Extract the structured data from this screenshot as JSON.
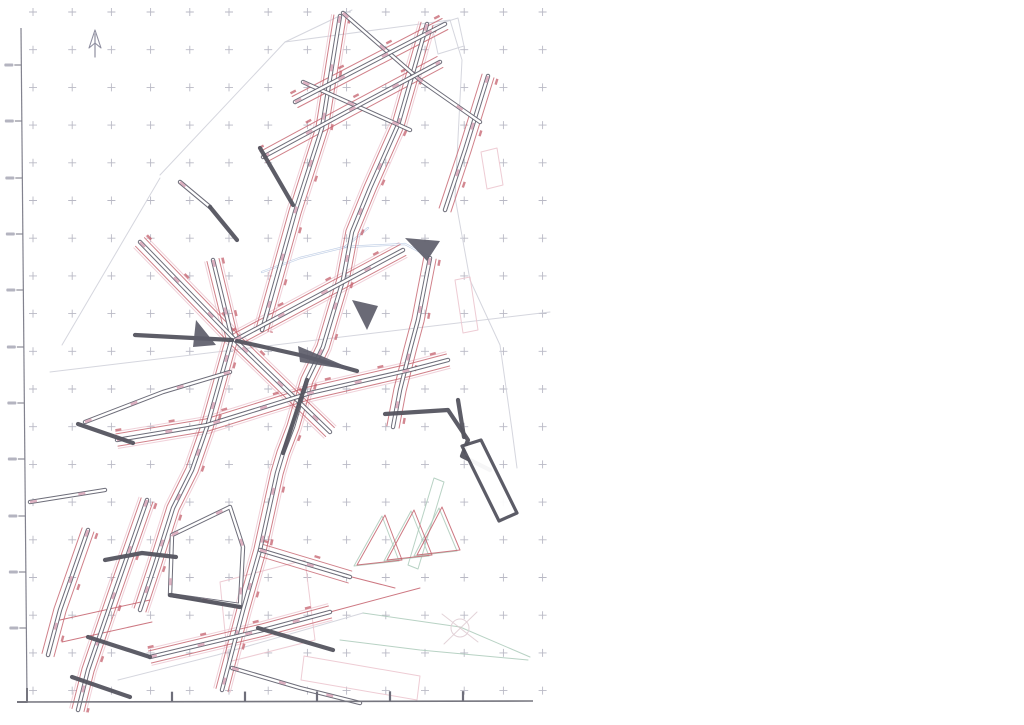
{
  "map": {
    "width": 1024,
    "height": 725,
    "colors": {
      "paper": "#ffffff",
      "cross": "#a8a8b6",
      "street_dark": "#61616e",
      "street_core": "#ffffff",
      "street_bold": "#54545f",
      "pink_blob": "#d9a9ba",
      "pink_line": "#ecc6cf",
      "red_line": "#c4606c",
      "green_line": "#abcaba",
      "blue_line": "#8aa6cf",
      "faint_gray": "#d0d2da",
      "ruler": "#82828e",
      "stub": "#b4b4c0",
      "wedge": "#5d5d6a"
    },
    "grid": {
      "x0": 33,
      "dx": 39.2,
      "cols": 14,
      "y0": 12,
      "dy": 37.7,
      "rows": 19,
      "arm": 4
    },
    "ruler": {
      "top": [
        21,
        28
      ],
      "bottom": [
        27,
        700
      ],
      "tick_ys": [
        65,
        121,
        178,
        234,
        290,
        347,
        403,
        459,
        516,
        572,
        628
      ],
      "tick_len": 7,
      "stub_w": 9,
      "stub_h": 3
    },
    "bottom_border": {
      "from": [
        17,
        702
      ],
      "to": [
        533,
        701
      ],
      "tick_xs": [
        172,
        245,
        317,
        390,
        463
      ],
      "tick_len": 10
    },
    "corner_mark": [
      [
        27,
        688
      ],
      [
        27,
        702
      ],
      [
        17,
        702
      ]
    ],
    "north_arrow": {
      "tail": [
        [
          95,
          57
        ],
        [
          95,
          34
        ]
      ],
      "head": [
        [
          89,
          48
        ],
        [
          95,
          30
        ],
        [
          101,
          48
        ],
        [
          95,
          43
        ]
      ]
    },
    "compass_star": {
      "cx": 460,
      "cy": 628,
      "r": 9,
      "lines": [
        [
          [
            442,
            614
          ],
          [
            478,
            642
          ]
        ],
        [
          [
            444,
            644
          ],
          [
            477,
            612
          ]
        ]
      ]
    },
    "layers": {
      "faint": [
        [
          [
            160,
            175
          ],
          [
            285,
            42
          ],
          [
            352,
            10
          ]
        ],
        [
          [
            285,
            42
          ],
          [
            450,
            20
          ],
          [
            462,
            60
          ],
          [
            455,
            197
          ]
        ],
        [
          [
            50,
            372
          ],
          [
            550,
            312
          ]
        ],
        [
          [
            118,
            680
          ],
          [
            217,
            655
          ],
          [
            363,
            613
          ]
        ],
        [
          [
            62,
            345
          ],
          [
            160,
            178
          ]
        ],
        [
          [
            432,
            26
          ],
          [
            458,
            18
          ],
          [
            464,
            46
          ],
          [
            438,
            54
          ],
          [
            432,
            26
          ]
        ],
        [
          [
            455,
            197
          ],
          [
            470,
            280
          ],
          [
            500,
            345
          ],
          [
            512,
            430
          ],
          [
            517,
            468
          ]
        ]
      ],
      "green": [
        [
          [
            363,
            613
          ],
          [
            460,
            627
          ],
          [
            530,
            657
          ]
        ],
        [
          [
            340,
            640
          ],
          [
            420,
            650
          ],
          [
            528,
            660
          ]
        ],
        [
          [
            408,
            565
          ],
          [
            434,
            478
          ],
          [
            444,
            482
          ],
          [
            418,
            569
          ],
          [
            408,
            565
          ]
        ],
        [
          [
            354,
            566
          ],
          [
            382,
            516
          ],
          [
            399,
            561
          ],
          [
            354,
            566
          ]
        ],
        [
          [
            384,
            561
          ],
          [
            411,
            511
          ],
          [
            429,
            556
          ],
          [
            384,
            561
          ]
        ],
        [
          [
            414,
            556
          ],
          [
            439,
            508
          ],
          [
            457,
            551
          ],
          [
            414,
            556
          ]
        ]
      ],
      "pink": [
        [
          [
            220,
            582
          ],
          [
            305,
            560
          ],
          [
            315,
            640
          ],
          [
            228,
            662
          ],
          [
            220,
            582
          ]
        ],
        [
          [
            304,
            656
          ],
          [
            420,
            676
          ],
          [
            417,
            700
          ],
          [
            301,
            680
          ],
          [
            304,
            656
          ]
        ],
        [
          [
            455,
            280
          ],
          [
            470,
            277
          ],
          [
            478,
            330
          ],
          [
            463,
            333
          ],
          [
            455,
            280
          ]
        ],
        [
          [
            481,
            152
          ],
          [
            497,
            148
          ],
          [
            503,
            185
          ],
          [
            487,
            189
          ],
          [
            481,
            152
          ]
        ]
      ],
      "blue": [
        [
          [
            262,
            272
          ],
          [
            300,
            258
          ],
          [
            345,
            247
          ],
          [
            405,
            244
          ],
          [
            428,
            256
          ]
        ],
        [
          [
            345,
            247
          ],
          [
            368,
            228
          ]
        ]
      ],
      "red": [
        [
          [
            330,
            612
          ],
          [
            420,
            588
          ]
        ],
        [
          [
            60,
            620
          ],
          [
            150,
            600
          ]
        ],
        [
          [
            62,
            642
          ],
          [
            152,
            622
          ]
        ],
        [
          [
            352,
            577
          ],
          [
            395,
            588
          ]
        ],
        [
          [
            357,
            565
          ],
          [
            385,
            515
          ],
          [
            402,
            560
          ],
          [
            357,
            565
          ]
        ],
        [
          [
            387,
            560
          ],
          [
            414,
            510
          ],
          [
            432,
            555
          ],
          [
            387,
            560
          ]
        ],
        [
          [
            417,
            555
          ],
          [
            442,
            507
          ],
          [
            460,
            550
          ],
          [
            417,
            555
          ]
        ]
      ],
      "streets": [
        {
          "pts": [
            [
              340,
              16
            ],
            [
              322,
              128
            ],
            [
              295,
              212
            ],
            [
              262,
              330
            ]
          ],
          "red": true,
          "pink": true
        },
        {
          "pts": [
            [
              427,
              24
            ],
            [
              398,
              125
            ],
            [
              370,
              188
            ],
            [
              352,
              232
            ],
            [
              343,
              280
            ],
            [
              323,
              347
            ],
            [
              307,
              380
            ],
            [
              293,
              427
            ],
            [
              283,
              453
            ],
            [
              277,
              473
            ],
            [
              260,
              550
            ],
            [
              243,
              610
            ],
            [
              222,
              690
            ]
          ],
          "red": true,
          "pink": true
        },
        {
          "pts": [
            [
              488,
              76
            ],
            [
              465,
              150
            ],
            [
              445,
              210
            ]
          ],
          "red": true,
          "pink": false
        },
        {
          "pts": [
            [
              430,
              258
            ],
            [
              418,
              320
            ],
            [
              410,
              350
            ],
            [
              400,
              390
            ],
            [
              393,
              427
            ]
          ],
          "red": true,
          "pink": false
        },
        {
          "pts": [
            [
              213,
              260
            ],
            [
              232,
              338
            ],
            [
              207,
              427
            ],
            [
              192,
              470
            ],
            [
              173,
              508
            ],
            [
              155,
              565
            ],
            [
              140,
              610
            ]
          ],
          "red": true,
          "pink": true
        },
        {
          "pts": [
            [
              147,
              500
            ],
            [
              113,
              597
            ],
            [
              88,
              670
            ],
            [
              78,
              710
            ]
          ],
          "red": true,
          "pink": true
        },
        {
          "pts": [
            [
              88,
              530
            ],
            [
              60,
              610
            ],
            [
              48,
              655
            ]
          ],
          "red": true,
          "pink": false
        },
        {
          "pts": [
            [
              343,
              13
            ],
            [
              420,
              80
            ],
            [
              480,
              122
            ]
          ],
          "red": false,
          "pink": false
        },
        {
          "pts": [
            [
              303,
              82
            ],
            [
              410,
              130
            ]
          ],
          "red": false,
          "pink": false
        },
        {
          "pts": [
            [
              180,
              182
            ],
            [
              210,
              207
            ]
          ],
          "red": false,
          "pink": false
        },
        {
          "pts": [
            [
              140,
              242
            ],
            [
              235,
              340
            ],
            [
              330,
              432
            ]
          ],
          "red": true,
          "pink": true
        },
        {
          "pts": [
            [
              260,
              550
            ],
            [
              350,
              577
            ]
          ],
          "red": true,
          "pink": false
        },
        {
          "pts": [
            [
              295,
              102
            ],
            [
              445,
              24
            ]
          ],
          "red": true,
          "pink": false
        },
        {
          "pts": [
            [
              263,
              157
            ],
            [
              350,
              110
            ],
            [
              440,
              62
            ]
          ],
          "red": true,
          "pink": false
        },
        {
          "pts": [
            [
              235,
              340
            ],
            [
              403,
              250
            ]
          ],
          "red": true,
          "pink": true
        },
        {
          "pts": [
            [
              117,
              440
            ],
            [
              207,
              425
            ],
            [
              310,
              393
            ],
            [
              410,
              370
            ],
            [
              448,
              360
            ]
          ],
          "red": true,
          "pink": true
        },
        {
          "pts": [
            [
              85,
              422
            ],
            [
              163,
              392
            ],
            [
              230,
              372
            ]
          ],
          "red": false,
          "pink": false
        },
        {
          "pts": [
            [
              172,
              535
            ],
            [
              230,
              507
            ],
            [
              243,
              547
            ],
            [
              240,
              605
            ],
            [
              170,
              595
            ],
            [
              172,
              535
            ]
          ],
          "red": false,
          "pink": false
        },
        {
          "pts": [
            [
              150,
              657
            ],
            [
              263,
              630
            ],
            [
              330,
              612
            ]
          ],
          "red": true,
          "pink": true
        },
        {
          "pts": [
            [
              30,
              502
            ],
            [
              105,
              490
            ]
          ],
          "red": false,
          "pink": false
        },
        {
          "pts": [
            [
              232,
              668
            ],
            [
              300,
              688
            ],
            [
              360,
              703
            ]
          ],
          "red": false,
          "pink": false
        }
      ],
      "bold": [
        [
          [
            210,
            207
          ],
          [
            237,
            240
          ]
        ],
        [
          [
            260,
            148
          ],
          [
            293,
            205
          ]
        ],
        [
          [
            135,
            335
          ],
          [
            232,
            340
          ]
        ],
        [
          [
            78,
            424
          ],
          [
            133,
            443
          ]
        ],
        [
          [
            105,
            560
          ],
          [
            142,
            553
          ],
          [
            176,
            557
          ]
        ],
        [
          [
            88,
            637
          ],
          [
            150,
            657
          ]
        ],
        [
          [
            72,
            677
          ],
          [
            130,
            697
          ]
        ],
        [
          [
            385,
            414
          ],
          [
            448,
            410
          ],
          [
            468,
            440
          ],
          [
            462,
            456
          ],
          [
            490,
            470
          ]
        ],
        [
          [
            307,
            380
          ],
          [
            283,
            453
          ]
        ],
        [
          [
            237,
            341
          ],
          [
            300,
            355
          ],
          [
            357,
            371
          ]
        ],
        [
          [
            458,
            400
          ],
          [
            464,
            437
          ]
        ],
        [
          [
            170,
            595
          ],
          [
            240,
            607
          ]
        ],
        [
          [
            258,
            628
          ],
          [
            333,
            650
          ]
        ]
      ],
      "wedges": [
        [
          [
            405,
            238
          ],
          [
            440,
            241
          ],
          [
            427,
            261
          ]
        ],
        [
          [
            352,
            300
          ],
          [
            378,
            306
          ],
          [
            367,
            330
          ]
        ],
        [
          [
            196,
            320
          ],
          [
            216,
            345
          ],
          [
            193,
            347
          ]
        ],
        [
          [
            298,
            346
          ],
          [
            357,
            371
          ],
          [
            300,
            362
          ]
        ]
      ],
      "long_block": [
        [
          462,
          446
        ],
        [
          481,
          440
        ],
        [
          517,
          513
        ],
        [
          499,
          521
        ],
        [
          462,
          446
        ]
      ]
    }
  }
}
